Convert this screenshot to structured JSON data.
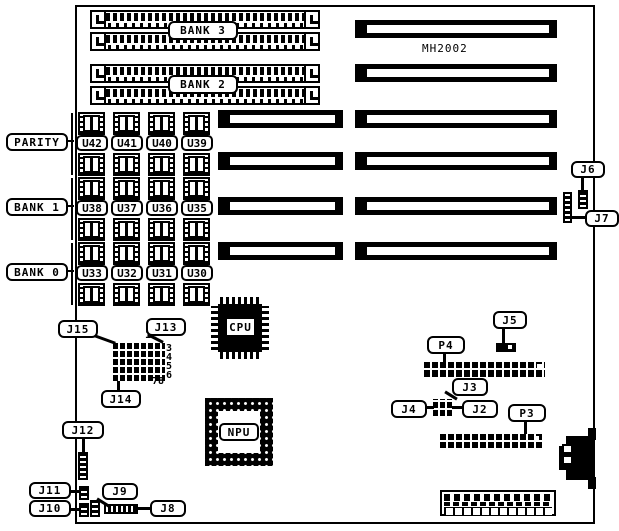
{
  "diagram_type": "motherboard-layout",
  "board": {
    "model": "MH2002"
  },
  "banks": [
    {
      "label": "BANK 3"
    },
    {
      "label": "BANK 2"
    }
  ],
  "chip_groups": [
    {
      "label": "PARITY",
      "chips": [
        "U42",
        "U41",
        "U40",
        "U39"
      ]
    },
    {
      "label": "BANK 1",
      "chips": [
        "U38",
        "U37",
        "U36",
        "U35"
      ]
    },
    {
      "label": "BANK 0",
      "chips": [
        "U33",
        "U32",
        "U31",
        "U30"
      ]
    }
  ],
  "ics": {
    "cpu": "CPU",
    "npu": "NPU"
  },
  "callouts": {
    "j2": "J2",
    "j3": "J3",
    "j4": "J4",
    "j5": "J5",
    "j6": "J6",
    "j7": "J7",
    "j8": "J8",
    "j9": "J9",
    "j10": "J10",
    "j11": "J11",
    "j12": "J12",
    "j13": "J13",
    "j14": "J14",
    "j15": "J15",
    "p3": "P3",
    "p4": "P4"
  },
  "pin_labels": {
    "top": "12",
    "right": "3\n4\n5\n6",
    "bottom": "78"
  },
  "colors": {
    "ink": "#000000",
    "paper": "#ffffff"
  }
}
